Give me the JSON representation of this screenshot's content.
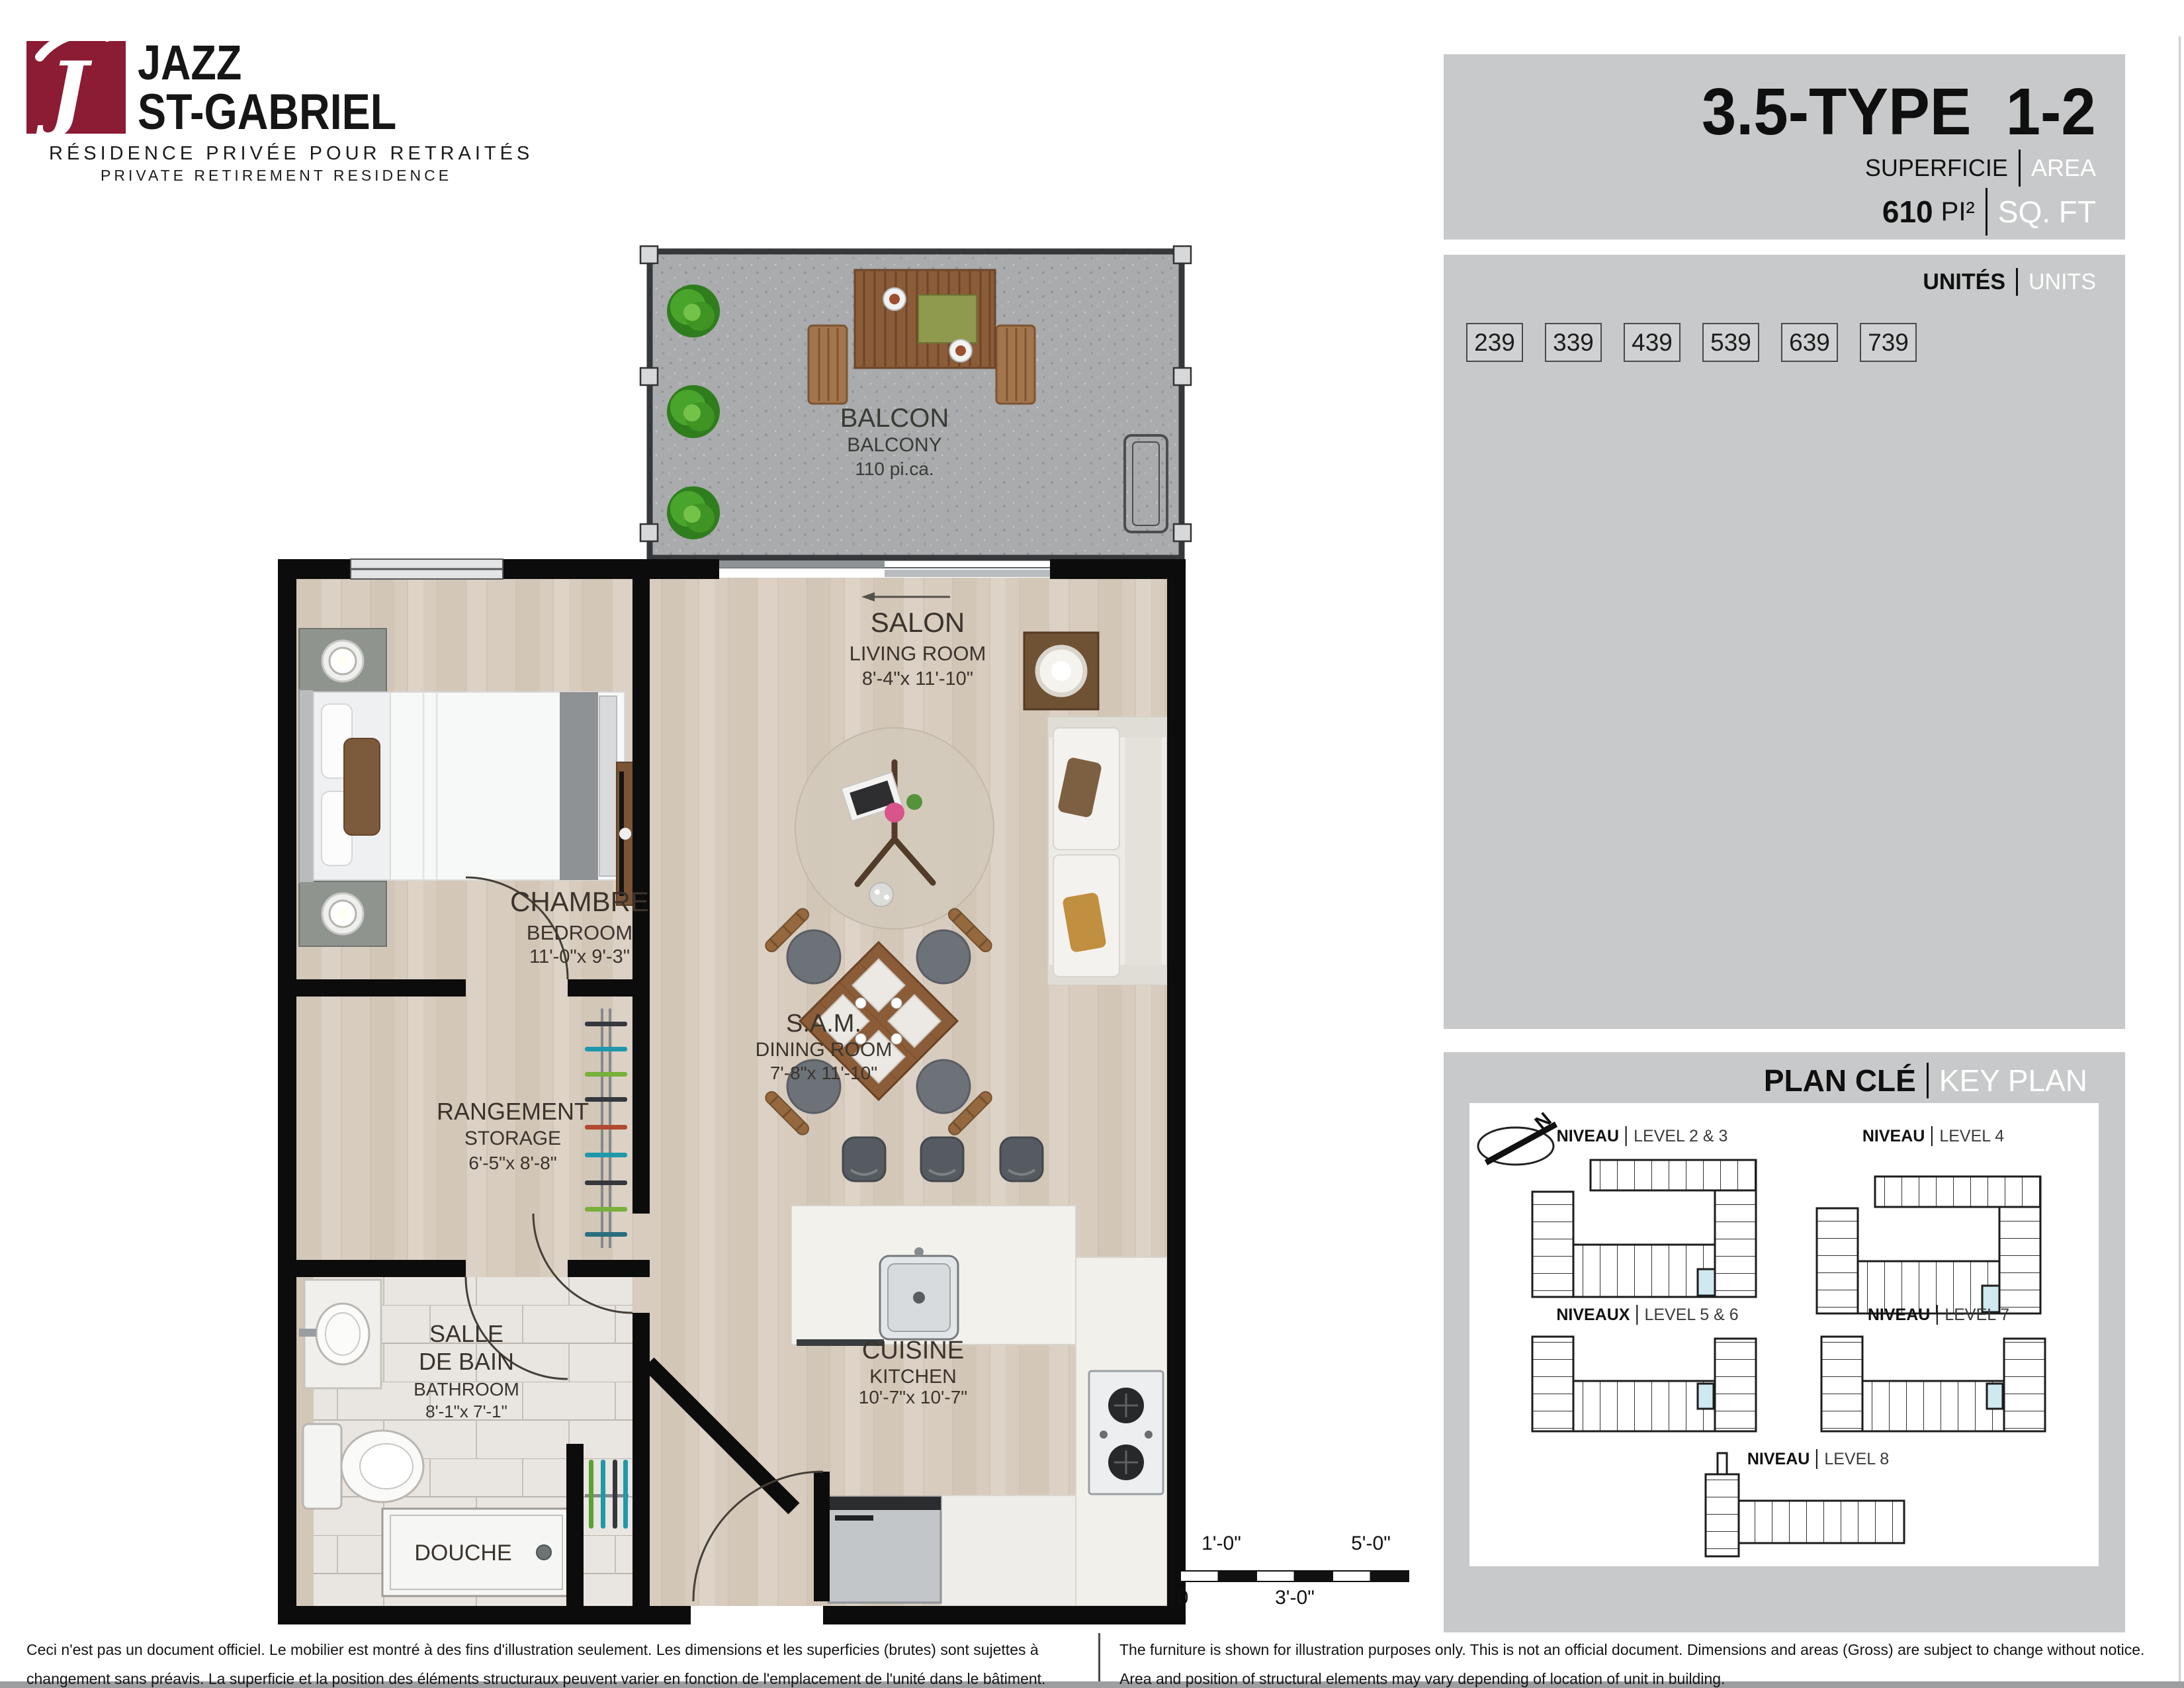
{
  "logo": {
    "monogram": "J",
    "brand_line1": "JAZZ",
    "brand_line2": "ST-GABRIEL",
    "tagline_fr": "RÉSIDENCE PRIVÉE POUR RETRAITÉS",
    "tagline_en": "PRIVATE RETIREMENT RESIDENCE",
    "brand_color": "#8c1b34"
  },
  "title_block": {
    "unit_type": "3.5-TYPE  1-2",
    "area_label_fr": "SUPERFICIE",
    "area_label_en": "AREA",
    "area_value": "610",
    "area_unit_fr": "PI²",
    "area_unit_en": "SQ. FT"
  },
  "units": {
    "label_fr": "UNITÉS",
    "label_en": "UNITS",
    "numbers": [
      "239",
      "339",
      "439",
      "539",
      "639",
      "739"
    ]
  },
  "key_plan": {
    "label_fr": "PLAN CLÉ",
    "label_en": "KEY PLAN",
    "north": "N",
    "highlight_color": "#cfe9f0",
    "levels": [
      {
        "fr": "NIVEAU",
        "en": "LEVEL 2 & 3"
      },
      {
        "fr": "NIVEAU",
        "en": "LEVEL 4"
      },
      {
        "fr": "NIVEAUX",
        "en": "LEVEL 5 & 6"
      },
      {
        "fr": "NIVEAU",
        "en": "LEVEL 7"
      },
      {
        "fr": "NIVEAU",
        "en": "LEVEL 8"
      }
    ]
  },
  "rooms": {
    "balcony": {
      "name_fr": "BALCON",
      "name_en": "BALCONY",
      "dims": "110 pi.ca."
    },
    "living": {
      "name_fr": "SALON",
      "name_en": "LIVING ROOM",
      "dims": "8'-4\"x 11'-10\""
    },
    "bedroom": {
      "name_fr": "CHAMBRE",
      "name_en": "BEDROOM",
      "dims": "11'-0\"x 9'-3\""
    },
    "storage": {
      "name_fr": "RANGEMENT",
      "name_en": "STORAGE",
      "dims": "6'-5\"x 8'-8\""
    },
    "dining": {
      "name_fr": "S.A.M.",
      "name_en": "DINING ROOM",
      "dims": "7'-8\"x 11'-10\""
    },
    "bathroom": {
      "name_fr_line1": "SALLE",
      "name_fr_line2": "DE BAIN",
      "name_en": "BATHROOM",
      "dims": "8'-1\"x 7'-1\""
    },
    "shower": {
      "name_fr": "DOUCHE"
    },
    "kitchen": {
      "name_fr": "CUISINE",
      "name_en": "KITCHEN",
      "dims": "10'-7\"x 10'-7\""
    }
  },
  "scale_bar": {
    "top_left": "1'-0\"",
    "top_right": "5'-0\"",
    "bottom_left": "0",
    "bottom_mid": "3'-0\""
  },
  "disclaimer_fr": "Ceci n'est pas un document officiel.  Le mobilier est montré à des fins d'illustration seulement.  Les dimensions et les superficies (brutes) sont sujettes à changement sans préavis. La superficie et la position des éléments structuraux peuvent varier en fonction de l'emplacement de l'unité dans le bâtiment.",
  "disclaimer_en": "The furniture is shown for illustration purposes only.  This is not an official document.  Dimensions and areas (Gross) are subject to change without notice. Area and position of structural elements may vary depending of location of unit in building."
}
